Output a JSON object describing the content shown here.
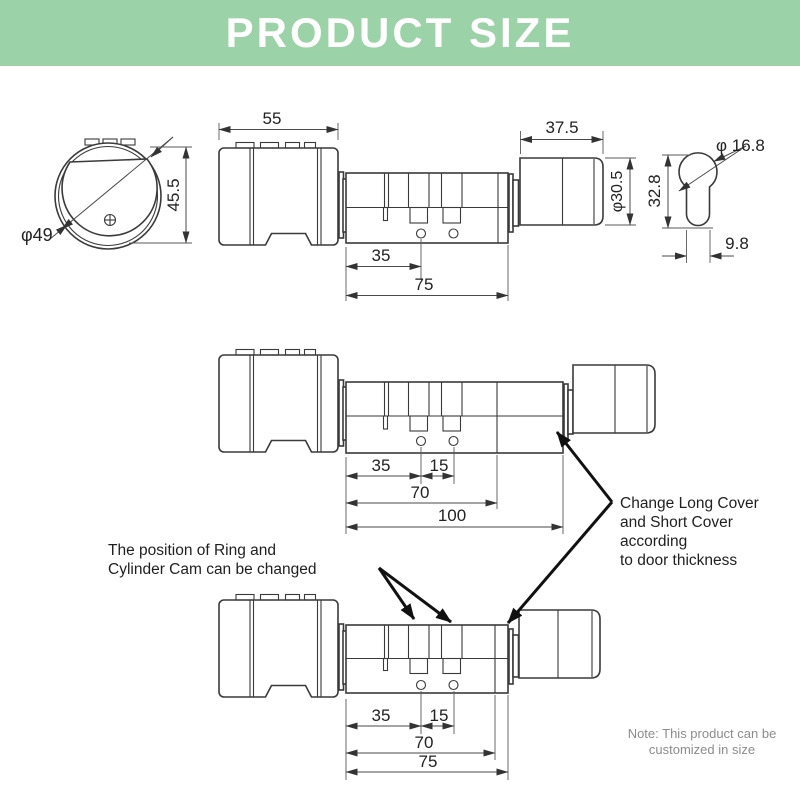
{
  "header": {
    "title": "PRODUCT SIZE",
    "bg_color": "#9cd2a7",
    "text_color": "#ffffff"
  },
  "front_view": {
    "diameter": "φ49",
    "height": "45.5"
  },
  "top_drawing": {
    "knob_width": "55",
    "dim_35": "35",
    "dim_75": "75",
    "cover_width": "37.5",
    "cover_diameter": "φ30.5"
  },
  "key_profile": {
    "diameter": "φ 16.8",
    "height": "32.8",
    "width": "9.8"
  },
  "middle_drawing": {
    "dim_35": "35",
    "dim_15": "15",
    "dim_70": "70",
    "dim_100": "100"
  },
  "bottom_drawing": {
    "dim_35": "35",
    "dim_15": "15",
    "dim_70": "70",
    "dim_75": "75"
  },
  "annotations": {
    "ring_cam": "The position of Ring and\nCylinder Cam can be changed",
    "cover_change": "Change Long Cover\nand Short Cover\naccording\nto door thickness",
    "note": "Note: This product can be\ncustomized in size"
  }
}
